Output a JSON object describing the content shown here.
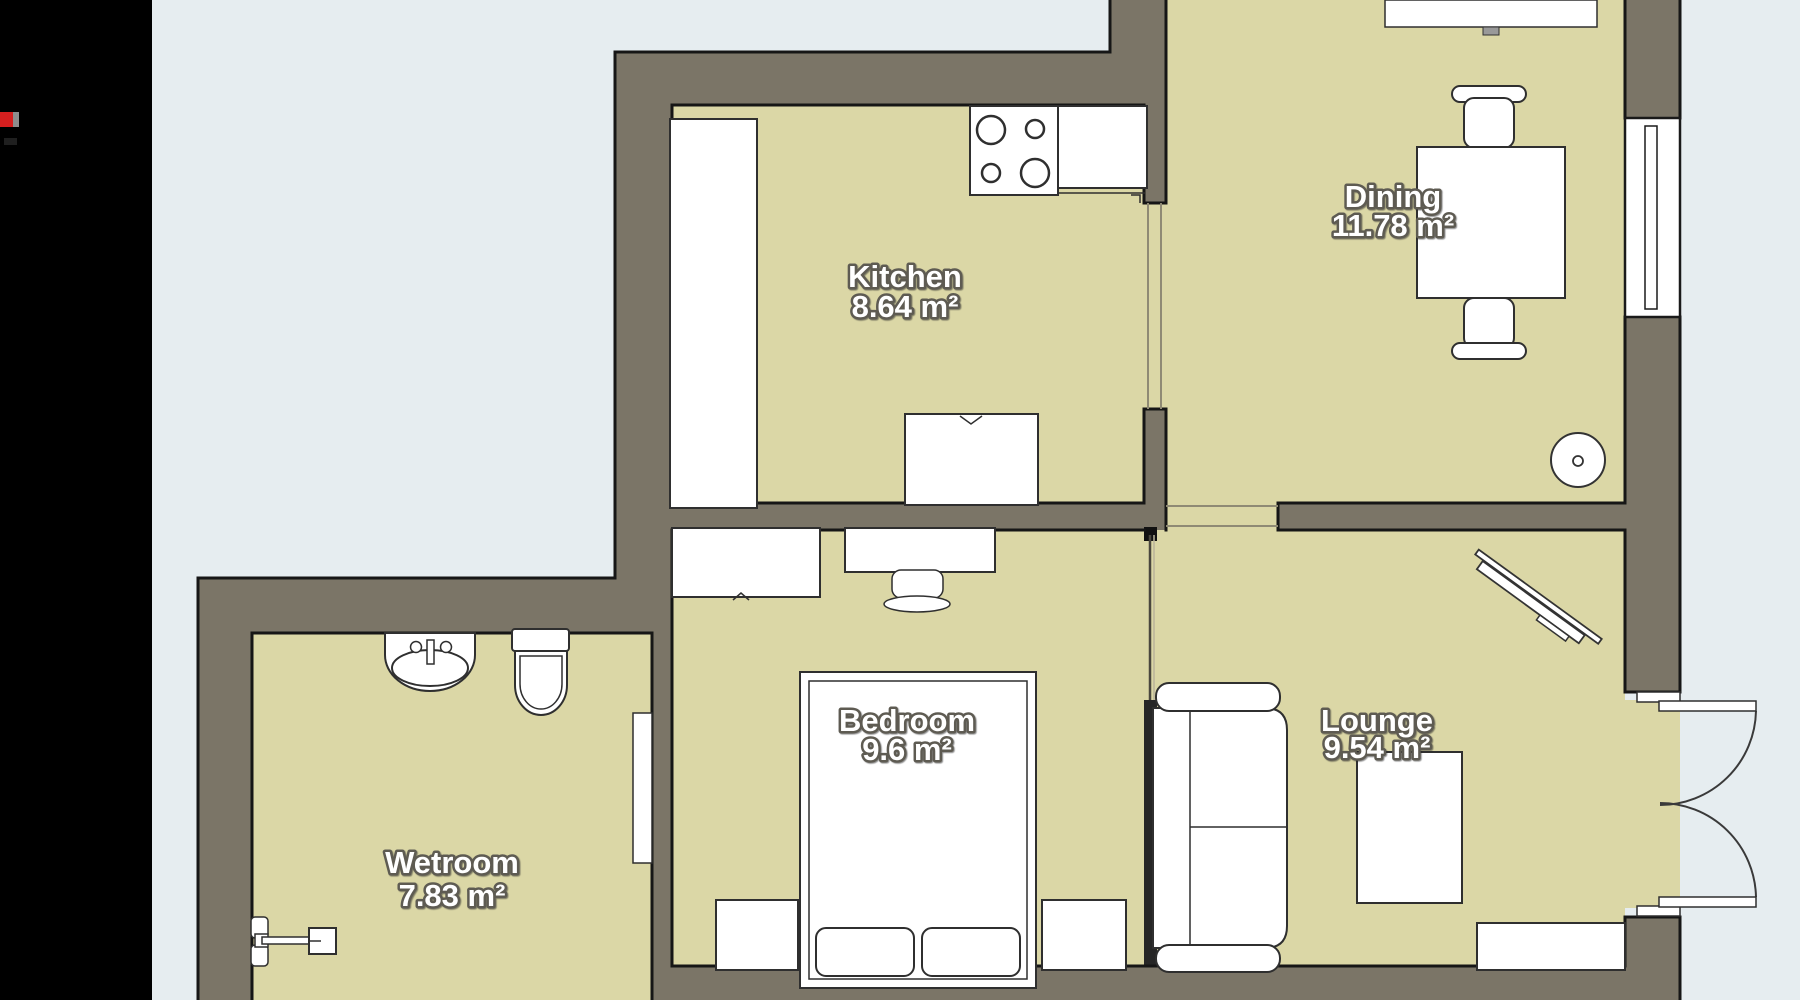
{
  "app": {
    "sidebar_color": "#000000",
    "background_color": "#e6edf0",
    "logo_red": "#d61f1f",
    "logo_gray": "#8d8d8d"
  },
  "palette": {
    "floor": "#dbd7a6",
    "wall": "#7b7567",
    "wall_outline": "#161616",
    "furniture": "#ffffff"
  },
  "rooms": {
    "kitchen": {
      "name": "Kitchen",
      "area": "8.64 m²"
    },
    "dining": {
      "name": "Dining",
      "area": "11.78 m²"
    },
    "bedroom": {
      "name": "Bedroom",
      "area": "9.6 m²"
    },
    "wetroom": {
      "name": "Wetroom",
      "area": "7.83 m²"
    },
    "lounge": {
      "name": "Lounge",
      "area": "9.54 m²"
    }
  }
}
